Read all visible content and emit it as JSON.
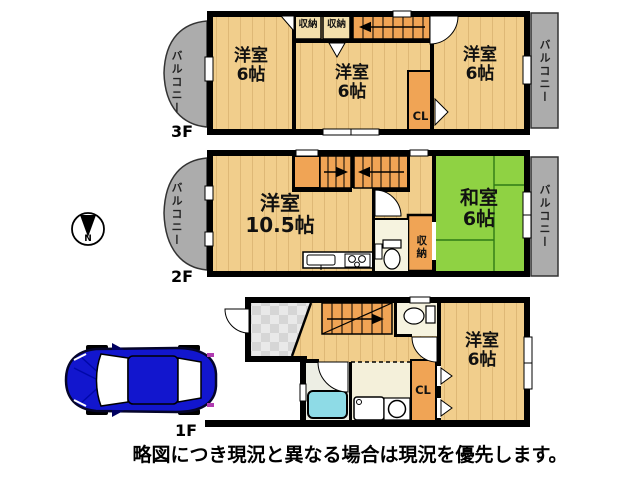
{
  "title": "間取り図",
  "disclaimer": "略図につき現況と異なる場合は現況を優先します。",
  "compass": {
    "north_label": "N"
  },
  "floors": {
    "f3": {
      "label": "3F",
      "balcony_left": "バルコニー",
      "balcony_right": "バルコニー",
      "room_left": "洋室\n6帖",
      "room_center": "洋室\n6帖",
      "room_right": "洋室\n6帖",
      "storage_1": "収納",
      "storage_2": "収納",
      "closet": "CL"
    },
    "f2": {
      "label": "2F",
      "balcony_left": "バルコニー",
      "balcony_right": "バルコニー",
      "room_left": "洋室\n10.5帖",
      "room_right": "和室\n6帖",
      "storage": "収納"
    },
    "f1": {
      "label": "1F",
      "room_right": "洋室\n6帖",
      "closet": "CL"
    }
  },
  "colors": {
    "wood_floor": "#F1CE8C",
    "accent_orange": "#F0A455",
    "tatami_green": "#8FD243",
    "balcony_gray": "#ACACAC",
    "bathtub_blue": "#8EDBE6",
    "car_blue": "#1216CE",
    "wall_black": "#000000"
  }
}
